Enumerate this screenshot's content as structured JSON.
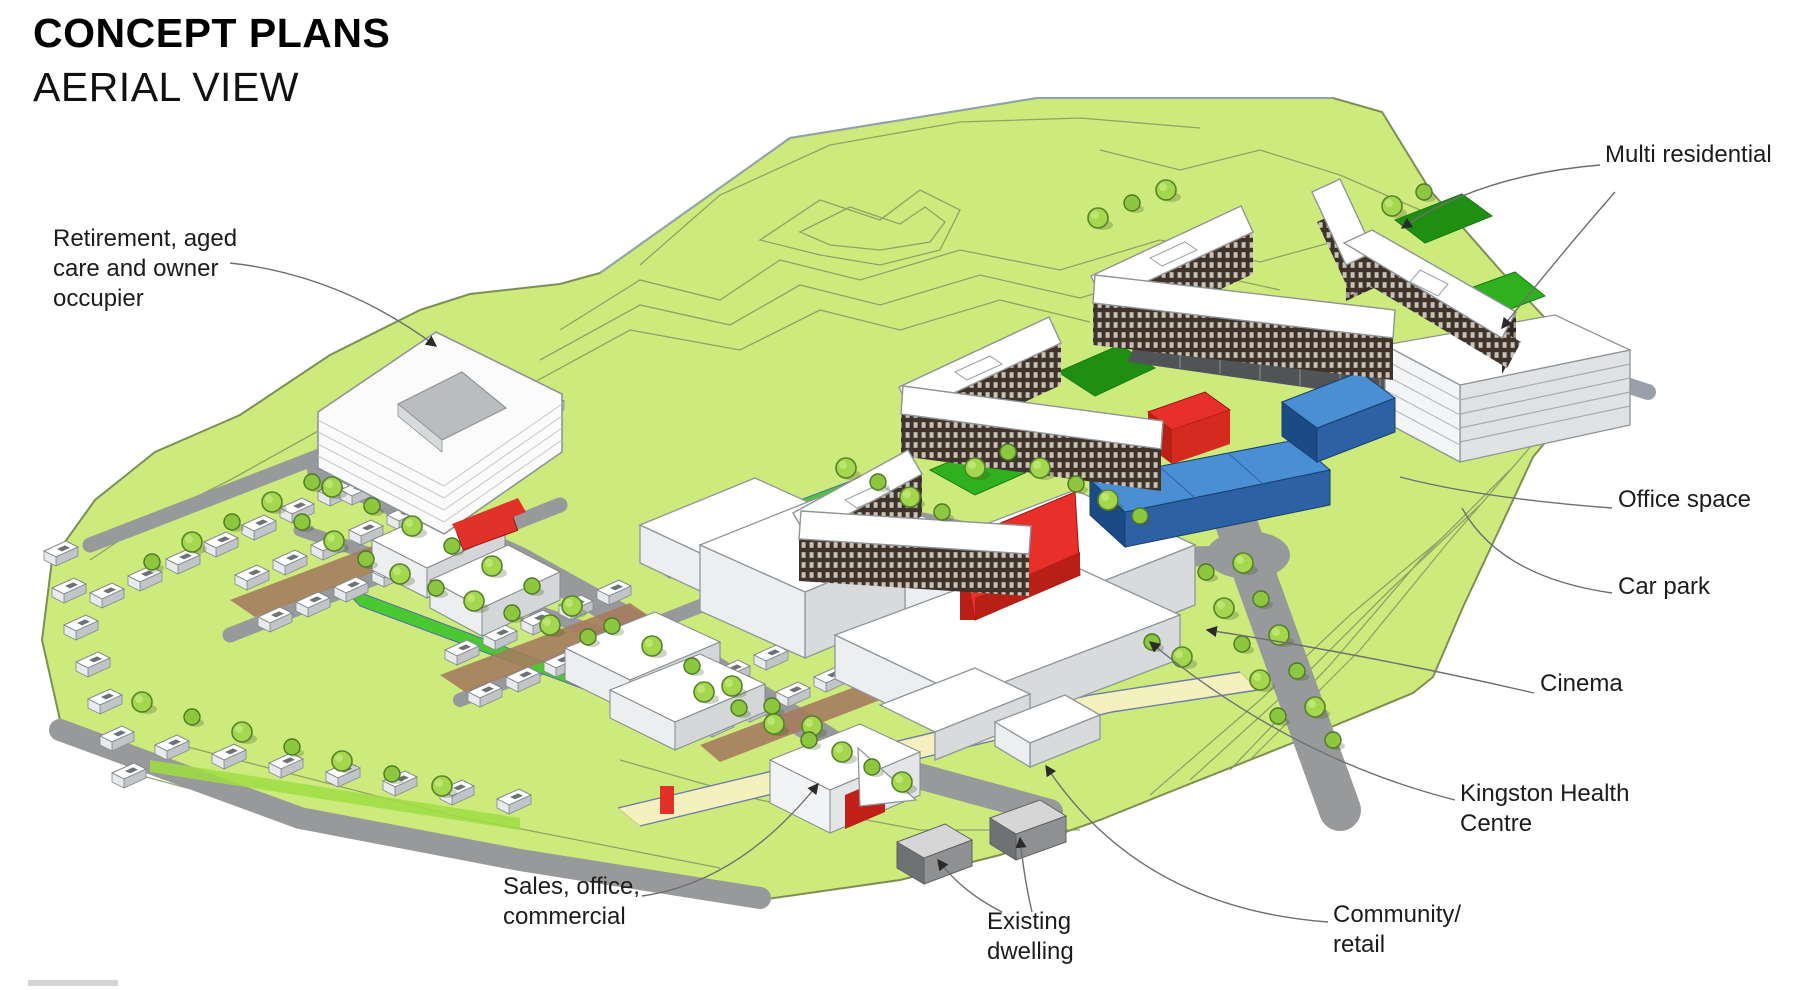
{
  "title": {
    "line1": "CONCEPT PLANS",
    "line2": "AERIAL VIEW"
  },
  "annotations": {
    "retirement": {
      "text": "Retirement, aged\ncare and owner\noccupier"
    },
    "multi_residential": {
      "text": "Multi residential"
    },
    "office_space": {
      "text": "Office space"
    },
    "car_park": {
      "text": "Car park"
    },
    "cinema": {
      "text": "Cinema"
    },
    "kingston_health": {
      "text": "Kingston Health\nCentre"
    },
    "community_retail": {
      "text": "Community/\nretail"
    },
    "existing_dwelling": {
      "text": "Existing\ndwelling"
    },
    "sales_office": {
      "text": "Sales, office,\ncommercial"
    }
  },
  "colors": {
    "terrain_green": "#cdea7d",
    "terrain_outline": "#7d8f52",
    "contour_line": "#8b9a63",
    "lawn_green": "#2eb01f",
    "lawn_green_dark": "#1f8f14",
    "tree_green": "#a5d74e",
    "road_grey": "#98999b",
    "podium_dark_grey": "#515457",
    "building_white": "#ffffff",
    "residential_brown": "#3f332b",
    "accent_red": "#e8302a",
    "accent_blue": "#4a8fd3",
    "path_yellow": "#f4f1bf",
    "courtyard_tan": "#a57c5d"
  }
}
